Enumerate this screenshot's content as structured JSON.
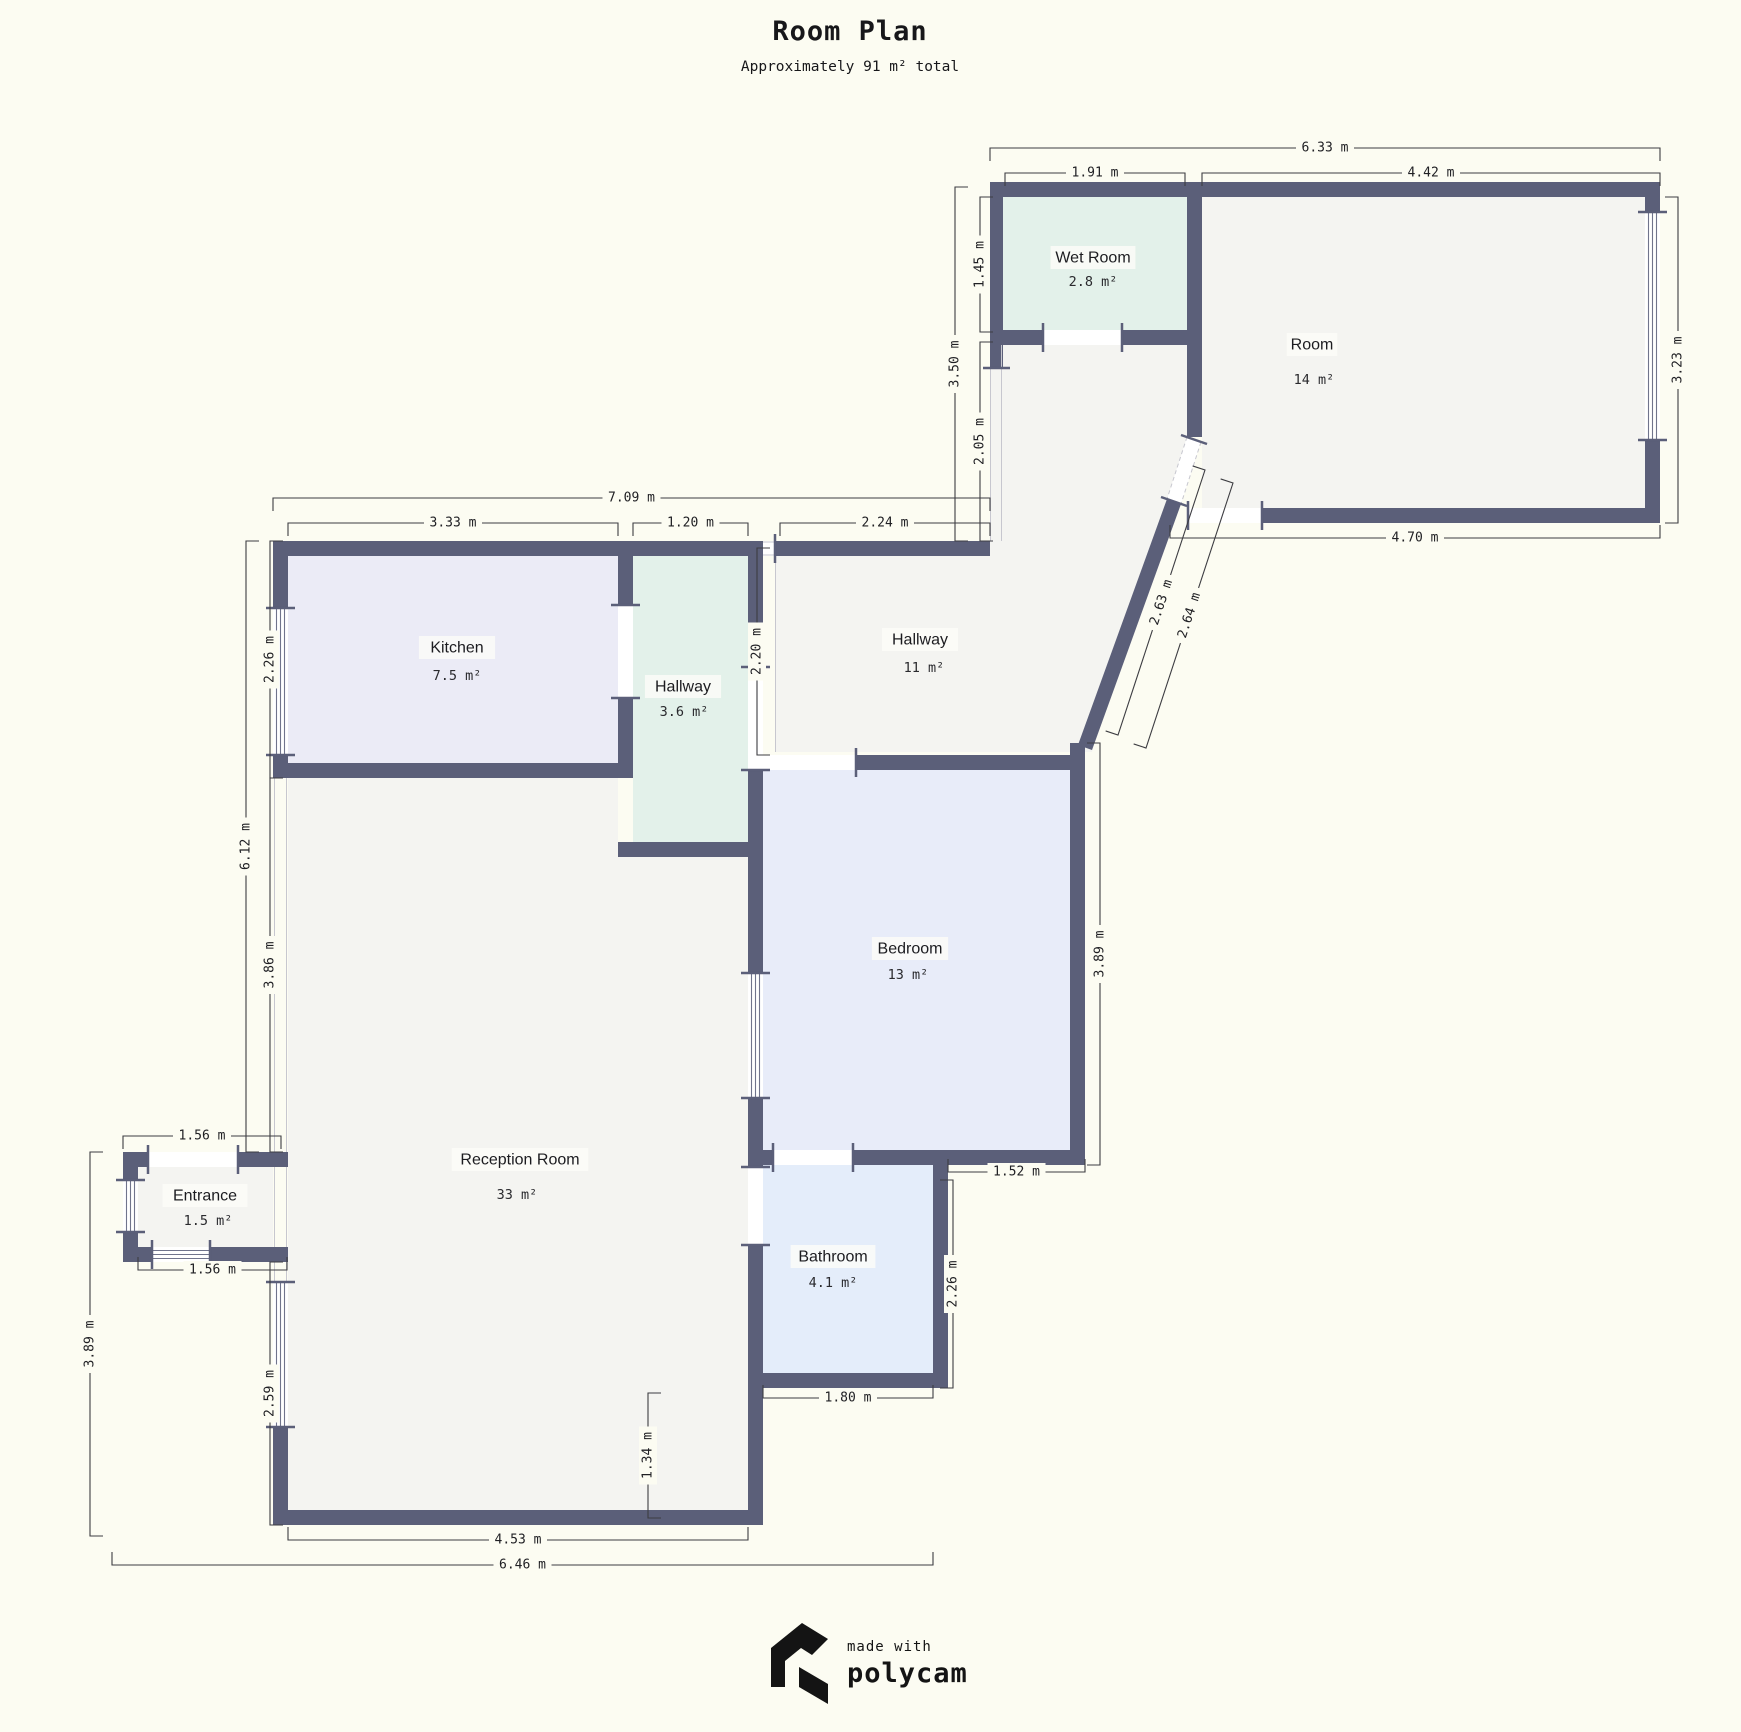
{
  "title": "Room Plan",
  "subtitle": "Approximately 91 m² total",
  "rooms": [
    {
      "name": "Wet Room",
      "area": "2.8 m²"
    },
    {
      "name": "Room",
      "area": "14 m²"
    },
    {
      "name": "Hallway",
      "area": "11 m²"
    },
    {
      "name": "Kitchen",
      "area": "7.5 m²"
    },
    {
      "name": "Hallway",
      "area": "3.6 m²"
    },
    {
      "name": "Bedroom",
      "area": "13 m²"
    },
    {
      "name": "Reception Room",
      "area": "33 m²"
    },
    {
      "name": "Bathroom",
      "area": "4.1 m²"
    },
    {
      "name": "Entrance",
      "area": "1.5 m²"
    }
  ],
  "dimensions": [
    {
      "label": "6.33 m"
    },
    {
      "label": "1.91 m"
    },
    {
      "label": "4.42 m"
    },
    {
      "label": "3.23 m"
    },
    {
      "label": "4.70 m"
    },
    {
      "label": "1.45 m"
    },
    {
      "label": "3.50 m"
    },
    {
      "label": "2.05 m"
    },
    {
      "label": "2.24 m"
    },
    {
      "label": "7.09 m"
    },
    {
      "label": "3.33 m"
    },
    {
      "label": "1.20 m"
    },
    {
      "label": "2.26 m"
    },
    {
      "label": "6.12 m"
    },
    {
      "label": "3.86 m"
    },
    {
      "label": "2.20 m"
    },
    {
      "label": "2.63 m"
    },
    {
      "label": "2.64 m"
    },
    {
      "label": "3.89 m"
    },
    {
      "label": "1.52 m"
    },
    {
      "label": "2.26 m"
    },
    {
      "label": "1.80 m"
    },
    {
      "label": "1.34 m"
    },
    {
      "label": "1.56 m"
    },
    {
      "label": "1.56 m"
    },
    {
      "label": "3.89 m"
    },
    {
      "label": "2.59 m"
    },
    {
      "label": "4.53 m"
    },
    {
      "label": "6.46 m"
    }
  ],
  "footer": {
    "made_with": "made with",
    "brand": "polycam"
  },
  "colors": {
    "background": "#fcfcf2",
    "wall": "#5b5f79",
    "floor": "#f4f4f1",
    "mint": "#e3f1ea",
    "lavender": "#ebebf6",
    "bedroom_blue": "#e8ecf9",
    "bathroom_blue": "#e4edfa",
    "dim_line": "#3d3d42"
  }
}
